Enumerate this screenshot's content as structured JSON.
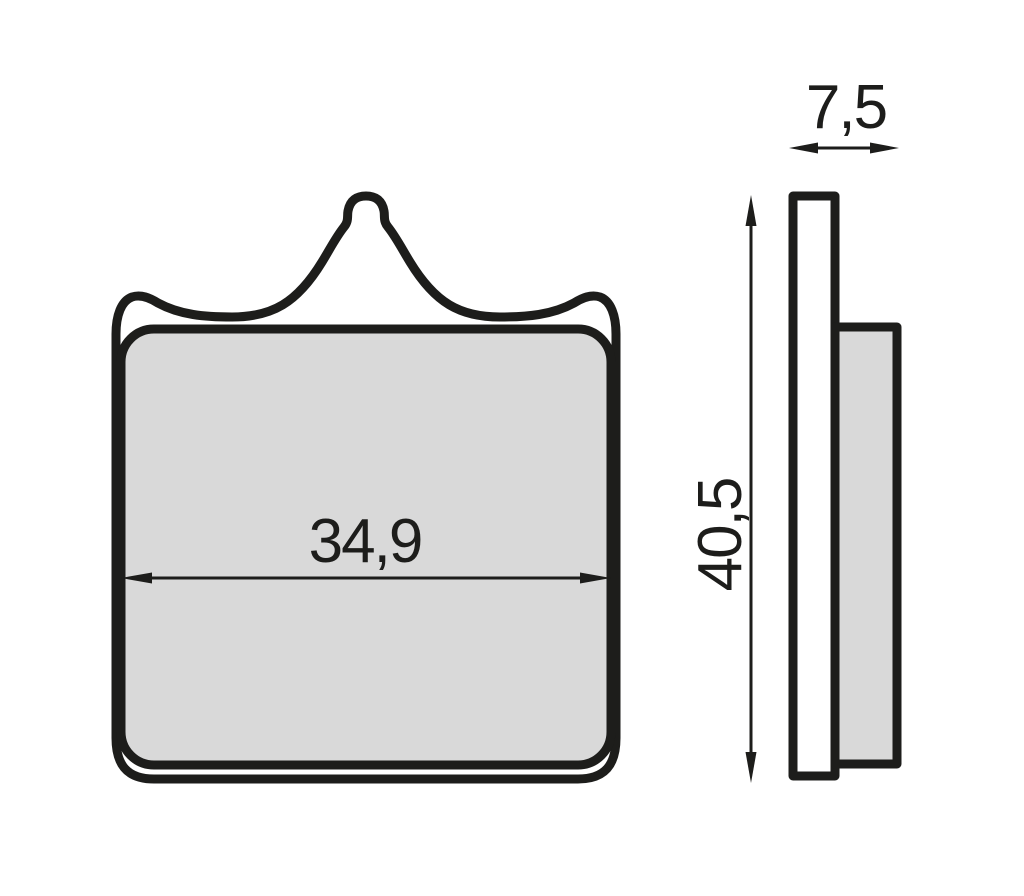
{
  "colors": {
    "background": "#ffffff",
    "outline": "#1d1d1b",
    "pad_fill": "#d9d9d9",
    "plate_fill": "#ffffff",
    "dimension": "#1d1d1b"
  },
  "front_view": {
    "width_dimension": {
      "label": "34,9"
    }
  },
  "side_view": {
    "thickness_dimension": {
      "label": "7,5"
    },
    "height_dimension": {
      "label": "40,5"
    }
  }
}
